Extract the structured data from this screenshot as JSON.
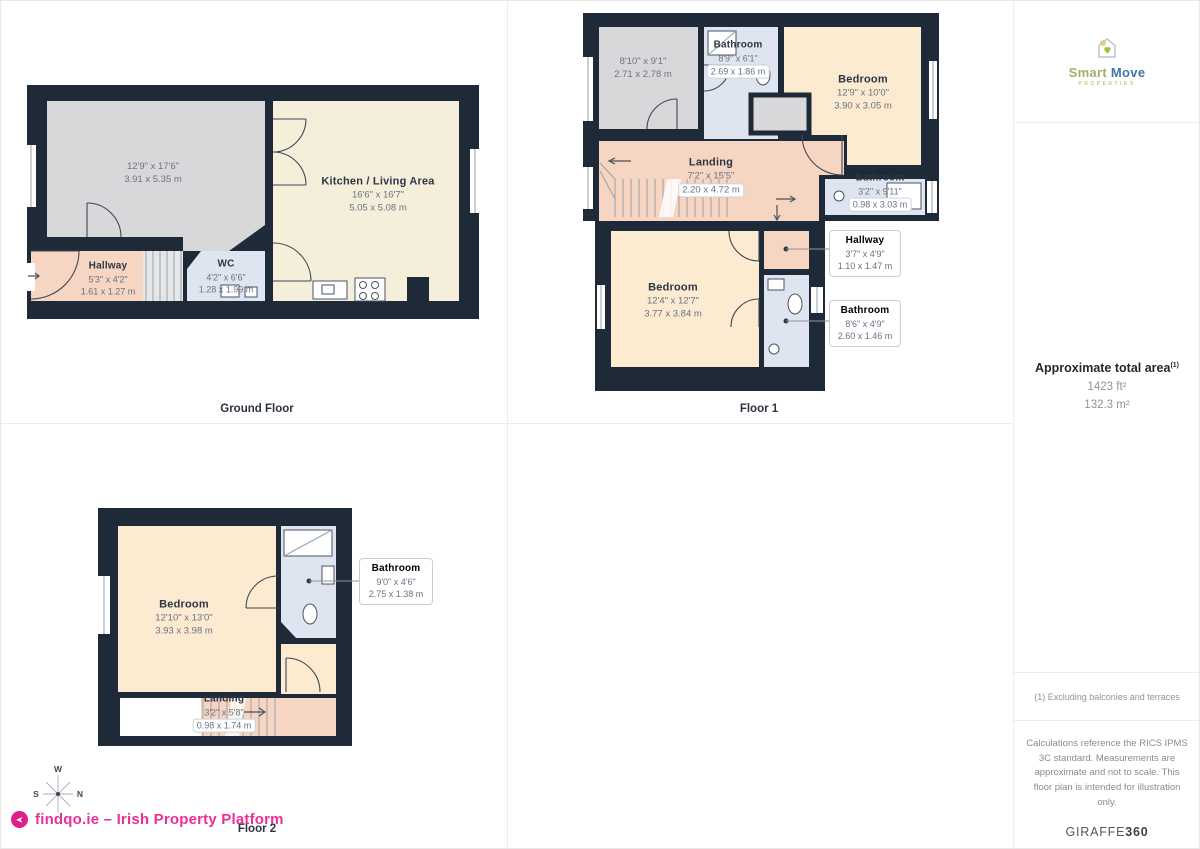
{
  "floors": {
    "ground": {
      "label": "Ground Floor",
      "rooms": {
        "living": {
          "dims_ft": "12'9\" x 17'6\"",
          "dims_m": "3.91 x 5.35 m"
        },
        "kitchen": {
          "name": "Kitchen / Living Area",
          "dims_ft": "16'6\" x 16'7\"",
          "dims_m": "5.05 x 5.08 m"
        },
        "hallway": {
          "name": "Hallway",
          "dims_ft": "5'3\" x 4'2\"",
          "dims_m": "1.61 x 1.27 m"
        },
        "wc": {
          "name": "WC",
          "dims_ft": "4'2\" x 6'6\"",
          "dims_m": "1.28 x 1.99 m"
        }
      }
    },
    "floor1": {
      "label": "Floor 1",
      "rooms": {
        "room": {
          "dims_ft": "8'10\" x 9'1\"",
          "dims_m": "2.71 x 2.78 m"
        },
        "bathroom_top": {
          "name": "Bathroom",
          "dims_ft": "8'9\" x 6'1\"",
          "dims_m": "2.69 x 1.86 m"
        },
        "bedroom_top": {
          "name": "Bedroom",
          "dims_ft": "12'9\" x 10'0\"",
          "dims_m": "3.90 x 3.05 m"
        },
        "landing": {
          "name": "Landing",
          "dims_ft": "7'2\" x 15'5\"",
          "dims_m": "2.20 x 4.72 m"
        },
        "bathroom_right": {
          "name": "Bathroom",
          "dims_ft": "3'2\" x 9'11\"",
          "dims_m": "0.98 x 3.03 m"
        },
        "bedroom": {
          "name": "Bedroom",
          "dims_ft": "12'4\" x 12'7\"",
          "dims_m": "3.77 x 3.84 m"
        }
      },
      "callouts": {
        "hallway": {
          "name": "Hallway",
          "dims_ft": "3'7\" x 4'9\"",
          "dims_m": "1.10 x 1.47 m"
        },
        "bathroom": {
          "name": "Bathroom",
          "dims_ft": "8'6\" x 4'9\"",
          "dims_m": "2.60 x 1.46 m"
        }
      }
    },
    "floor2": {
      "label": "Floor 2",
      "rooms": {
        "bedroom": {
          "name": "Bedroom",
          "dims_ft": "12'10\" x 13'0\"",
          "dims_m": "3.93 x 3.98 m"
        },
        "landing": {
          "name": "Landing",
          "dims_ft": "3'2\" x 5'8\"",
          "dims_m": "0.98 x 1.74 m"
        }
      },
      "callouts": {
        "bathroom": {
          "name": "Bathroom",
          "dims_ft": "9'0\" x 4'6\"",
          "dims_m": "2.75 x 1.38 m"
        }
      }
    }
  },
  "sidebar": {
    "logo": {
      "word1": "Smart",
      "word2": "Move",
      "tagline": "PROPERTIES"
    },
    "area": {
      "title": "Approximate total area",
      "sup": "(1)",
      "imperial": "1423 ft²",
      "metric": "132.3 m²"
    },
    "footnote": "(1) Excluding balconies and terraces",
    "disclaimer": "Calculations reference the RICS IPMS 3C standard. Measurements are approximate and not to scale. This floor plan is intended for illustration only.",
    "giraffe": {
      "brand": "GIRAFFE",
      "suffix": "360"
    }
  },
  "footer": {
    "branding": "findqo.ie – Irish Property Platform",
    "compass": {
      "top": "W",
      "left": "S",
      "right": "N"
    }
  },
  "colors": {
    "wall": "#1e2a38",
    "room_gray": "#d8d8da",
    "room_cream": "#f5eedb",
    "room_peach": "#f6d5c2",
    "room_warm": "#fcead1",
    "room_blue": "#dfe5f0",
    "accent_pink": "#ea2f96"
  }
}
